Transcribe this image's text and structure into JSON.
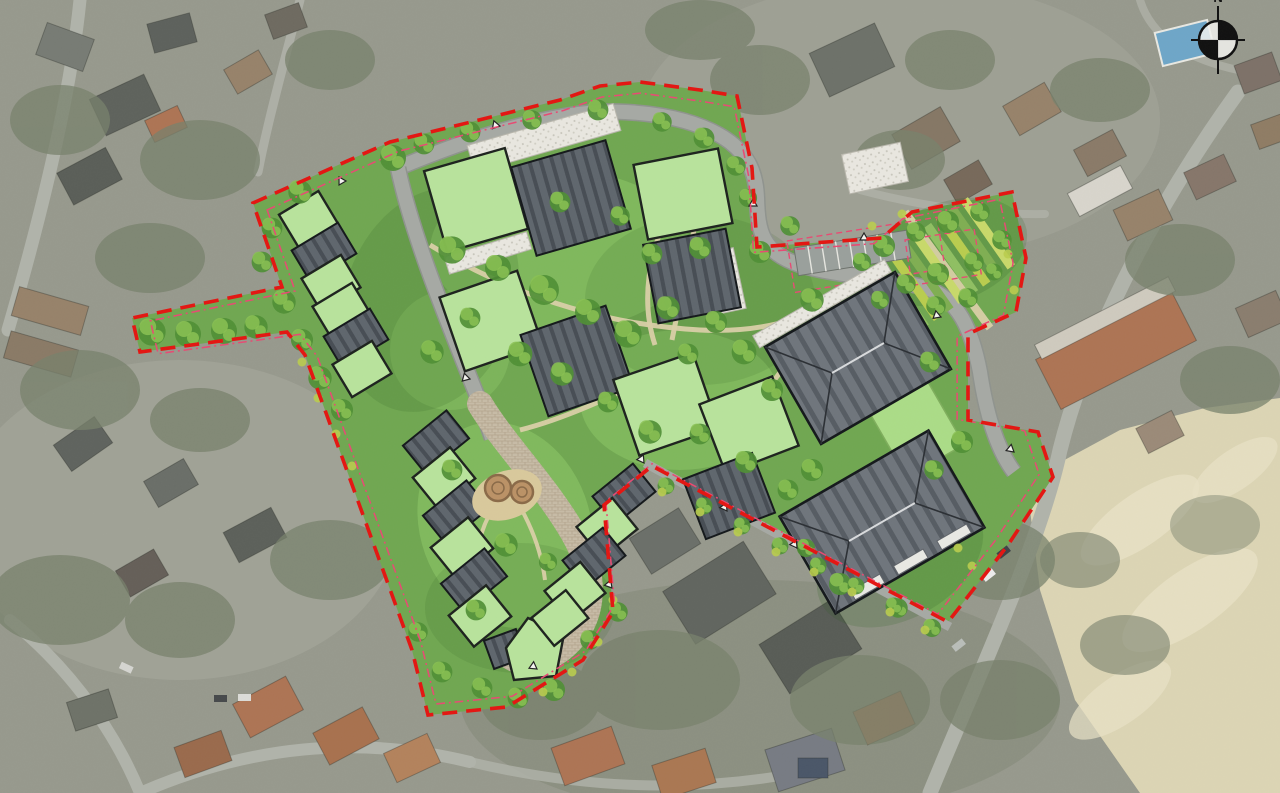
{
  "meta": {
    "description": "Aerial photograph of a suburban neighbourhood with a landscaped residential masterplan (site plan) overlaid; red dashed site boundary, internal loop road, green-roof and grey pitched-roof buildings, community garden, central play area",
    "visible_text": [
      "N"
    ]
  },
  "compass": {
    "north_label": "N"
  },
  "colors": {
    "aerial_base": "#97998d",
    "aerial_pale": "#a9ab9f",
    "aerial_veg": "#78816c",
    "aerial_road": "#b0b3aa",
    "aroof_dark": "#5e625c",
    "aroof_brown": "#97826a",
    "aroof_terra": "#ad7454",
    "sand": "#dcd5b4",
    "sand_light": "#e8e1c6",
    "pool": "#6ea6c8",
    "site_grass": "#70a751",
    "lawn_light": "#8ec968",
    "lawn_pale": "#abdc87",
    "roof_green": "#b8e39c",
    "roof_dark": "#5f666d",
    "roof_dark_stripe": "#474d54",
    "big_roof": "#6f757c",
    "road_gray": "#a6a9a4",
    "path_beige": "#d9cfa7",
    "gravel": "#e9e7e0",
    "tree_green": "#4f8f35",
    "tree_light": "#8ac152",
    "shrub_yellow": "#b9cc4e",
    "boundary_red": "#e41511",
    "setback_pink": "#e84a73",
    "outline_dark": "#1d221e",
    "compass": "#101010",
    "play_sand": "#d9c99c",
    "play_log": "#bb9266"
  }
}
